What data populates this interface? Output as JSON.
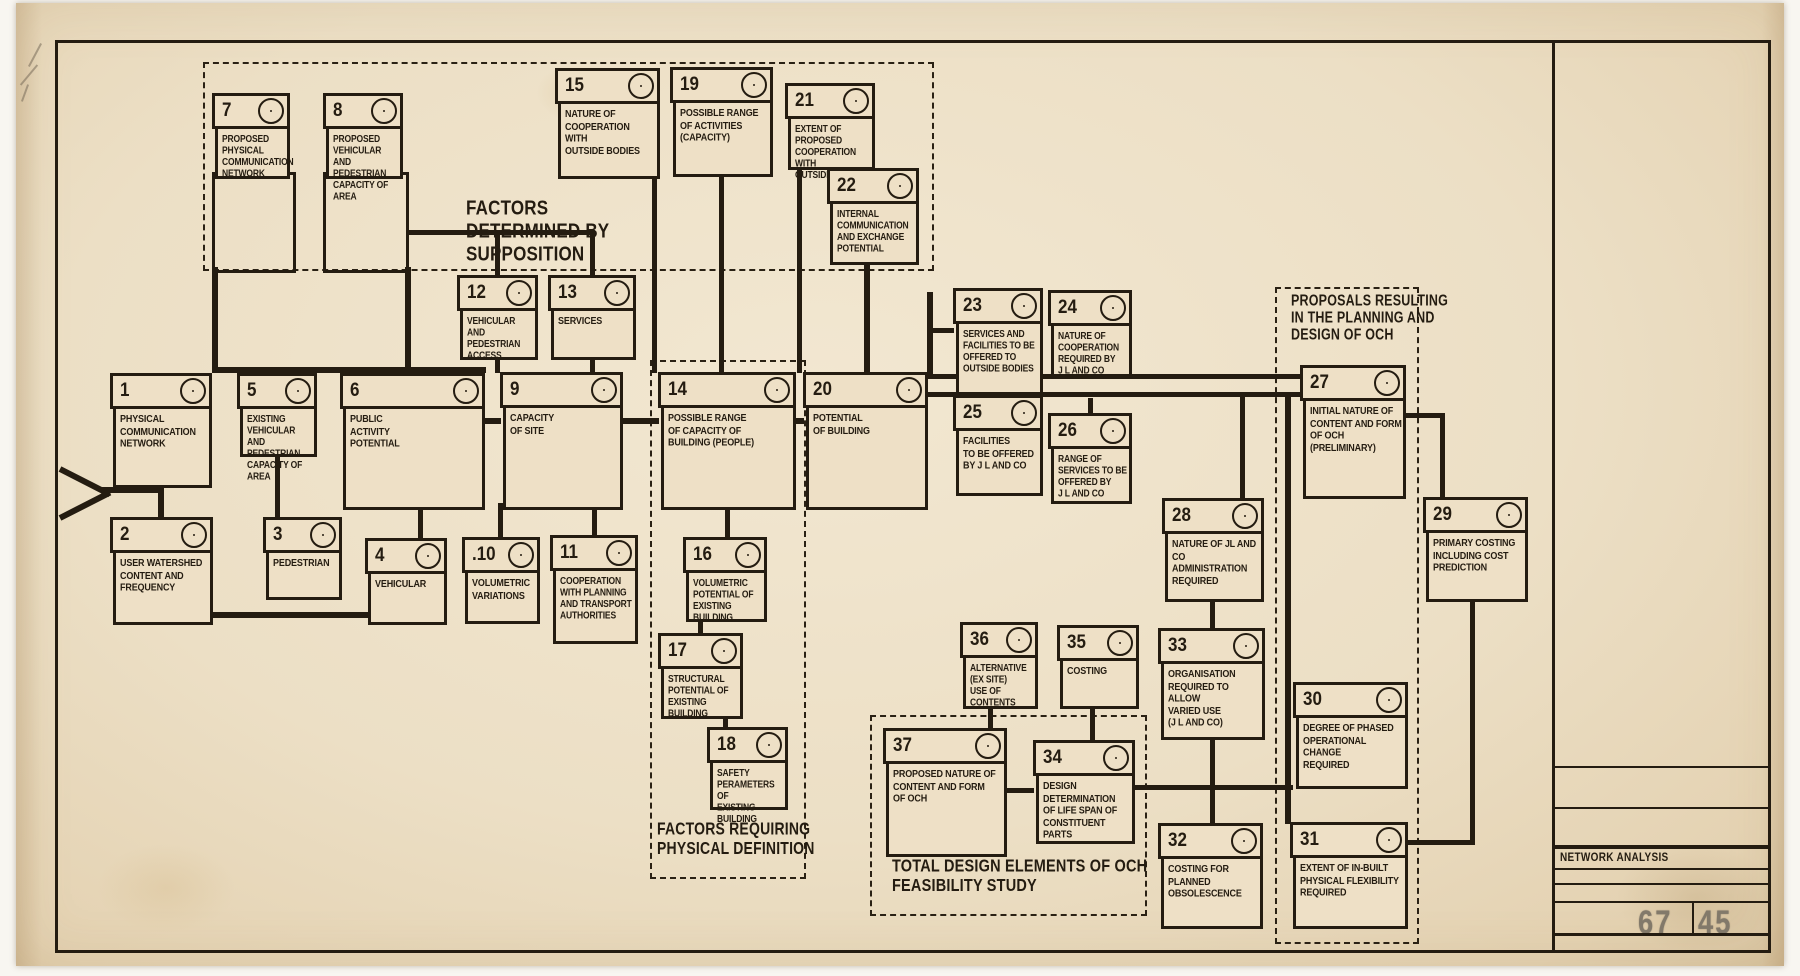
{
  "title_block": {
    "label": "NETWORK ANALYSIS",
    "sheet_number": "6745",
    "sheet_number_left": "67",
    "sheet_number_right": "45"
  },
  "colors": {
    "paper": "#ecdfc5",
    "ink": "#241c11",
    "stamp_grey": "#82796a"
  },
  "diagram": {
    "groups": [
      {
        "id": "supposition",
        "x": 203,
        "y": 62,
        "w": 727,
        "h": 205,
        "lx": 466,
        "ly": 196,
        "fs": 17,
        "label": "FACTORS\nDETERMINED BY\nSUPPOSITION"
      },
      {
        "id": "physical-definition",
        "x": 650,
        "y": 360,
        "w": 152,
        "h": 515,
        "lx": 657,
        "ly": 820,
        "fs": 14,
        "label": "FACTORS REQUIRING\nPHYSICAL DEFINITION"
      },
      {
        "id": "total-design",
        "x": 870,
        "y": 715,
        "w": 273,
        "h": 197,
        "lx": 892,
        "ly": 857,
        "fs": 14.5,
        "label": "TOTAL DESIGN ELEMENTS OF OCH\nFEASIBILITY STUDY"
      },
      {
        "id": "proposals",
        "x": 1275,
        "y": 287,
        "w": 140,
        "h": 653,
        "lx": 1291,
        "ly": 292,
        "fs": 12.5,
        "label": "PROPOSALS RESULTING\nIN THE PLANNING AND\nDESIGN OF OCH"
      }
    ],
    "nodes": [
      {
        "n": "1",
        "x": 110,
        "y": 373,
        "w": 102,
        "h": 76,
        "label": "PHYSICAL\nCOMMUNICATION\nNETWORK"
      },
      {
        "n": "2",
        "x": 110,
        "y": 517,
        "w": 103,
        "h": 69,
        "label": "USER WATERSHED\nCONTENT AND\nFREQUENCY"
      },
      {
        "n": "3",
        "x": 263,
        "y": 517,
        "w": 79,
        "h": 44,
        "label": "PEDESTRIAN"
      },
      {
        "n": "4",
        "x": 365,
        "y": 538,
        "w": 82,
        "h": 48,
        "label": "VEHICULAR"
      },
      {
        "n": "5",
        "x": 237,
        "y": 373,
        "w": 80,
        "h": 45,
        "fs": 8.5,
        "label": "EXISTING VEHICULAR\nAND PEDESTRIAN\nCAPACITY OF\nAREA"
      },
      {
        "n": "6",
        "x": 340,
        "y": 373,
        "w": 145,
        "h": 98,
        "label": "PUBLIC\nACTIVITY\nPOTENTIAL"
      },
      {
        "n": "7",
        "x": 212,
        "y": 93,
        "w": 78,
        "h": 47,
        "fs": 8.5,
        "label": "PROPOSED\nPHYSICAL\nCOMMUNICATION\nNETWORK"
      },
      {
        "n": "8",
        "x": 323,
        "y": 93,
        "w": 80,
        "h": 47,
        "fs": 8.5,
        "label": "PROPOSED\nVEHICULAR AND\nPEDESTRIAN\nCAPACITY OF AREA"
      },
      {
        "n": "9",
        "x": 500,
        "y": 372,
        "w": 123,
        "h": 99,
        "label": "CAPACITY\nOF SITE"
      },
      {
        "n": ".10",
        "x": 462,
        "y": 537,
        "w": 78,
        "h": 48,
        "label": "VOLUMETRIC\nVARIATIONS"
      },
      {
        "n": "11",
        "x": 550,
        "y": 535,
        "w": 88,
        "h": 70,
        "fs": 8.5,
        "label": "COOPERATION\nWITH PLANNING\nAND TRANSPORT\nAUTHORITIES"
      },
      {
        "n": "12",
        "x": 457,
        "y": 275,
        "w": 81,
        "h": 46,
        "fs": 8.5,
        "label": "VEHICULAR\nAND PEDESTRIAN\nACCESS"
      },
      {
        "n": "13",
        "x": 548,
        "y": 275,
        "w": 88,
        "h": 46,
        "label": "SERVICES"
      },
      {
        "n": "14",
        "x": 658,
        "y": 372,
        "w": 138,
        "h": 99,
        "label": "POSSIBLE RANGE\nOF CAPACITY OF\nBUILDING (PEOPLE)"
      },
      {
        "n": "15",
        "x": 555,
        "y": 68,
        "w": 105,
        "h": 72,
        "label": "NATURE OF\nCOOPERATION\nWITH\nOUTSIDE BODIES"
      },
      {
        "n": "16",
        "x": 683,
        "y": 537,
        "w": 84,
        "h": 46,
        "fs": 8.5,
        "label": "VOLUMETRIC\nPOTENTIAL OF\nEXISTING BUILDING"
      },
      {
        "n": "17",
        "x": 658,
        "y": 633,
        "w": 85,
        "h": 47,
        "fs": 8.5,
        "label": "STRUCTURAL\nPOTENTIAL OF\nEXISTING BUILDING"
      },
      {
        "n": "18",
        "x": 707,
        "y": 727,
        "w": 81,
        "h": 44,
        "fs": 8.5,
        "label": "SAFETY\nPERAMETERS OF\nEXISTING BUILDING"
      },
      {
        "n": "19",
        "x": 670,
        "y": 67,
        "w": 103,
        "h": 71,
        "label": "POSSIBLE RANGE\nOF ACTIVITIES\n(CAPACITY)"
      },
      {
        "n": "20",
        "x": 803,
        "y": 372,
        "w": 125,
        "h": 99,
        "label": "POTENTIAL\nOF BUILDING"
      },
      {
        "n": "21",
        "x": 785,
        "y": 83,
        "w": 90,
        "h": 48,
        "fs": 8.5,
        "label": "EXTENT OF\nPROPOSED\nCOOPERATION WITH\nOUTSIDE BODIES"
      },
      {
        "n": "22",
        "x": 827,
        "y": 168,
        "w": 92,
        "h": 58,
        "fs": 8.5,
        "label": "INTERNAL\nCOMMUNICATION\nAND EXCHANGE\nPOTENTIAL"
      },
      {
        "n": "23",
        "x": 953,
        "y": 288,
        "w": 90,
        "h": 68,
        "fs": 8.5,
        "label": "SERVICES AND\nFACILITIES TO BE\nOFFERED TO\nOUTSIDE BODIES"
      },
      {
        "n": "24",
        "x": 1048,
        "y": 290,
        "w": 84,
        "h": 48,
        "fs": 8.5,
        "label": "NATURE OF\nCOOPERATION\nREQUIRED BY\nJ L AND CO"
      },
      {
        "n": "25",
        "x": 953,
        "y": 395,
        "w": 90,
        "h": 62,
        "label": "FACILITIES\nTO BE OFFERED\nBY J L AND CO"
      },
      {
        "n": "26",
        "x": 1048,
        "y": 413,
        "w": 84,
        "h": 52,
        "fs": 8.5,
        "label": "RANGE OF\nSERVICES TO BE\nOFFERED BY\nJ L AND CO"
      },
      {
        "n": "27",
        "x": 1300,
        "y": 365,
        "w": 106,
        "h": 95,
        "label": "INITIAL NATURE OF\nCONTENT AND FORM\nOF OCH (PRELIMINARY)"
      },
      {
        "n": "28",
        "x": 1162,
        "y": 498,
        "w": 102,
        "h": 65,
        "label": "NATURE OF JL AND CO\nADMINISTRATION\nREQUIRED"
      },
      {
        "n": "29",
        "x": 1423,
        "y": 497,
        "w": 105,
        "h": 66,
        "label": "PRIMARY COSTING\nINCLUDING COST\nPREDICTION"
      },
      {
        "n": "30",
        "x": 1293,
        "y": 682,
        "w": 115,
        "h": 68,
        "label": "DEGREE OF PHASED\nOPERATIONAL CHANGE\nREQUIRED"
      },
      {
        "n": "31",
        "x": 1290,
        "y": 822,
        "w": 118,
        "h": 68,
        "label": "EXTENT OF IN-BUILT\nPHYSICAL FLEXIBILITY\nREQUIRED"
      },
      {
        "n": "32",
        "x": 1158,
        "y": 823,
        "w": 105,
        "h": 67,
        "label": "COSTING FOR\nPLANNED OBSOLESCENCE"
      },
      {
        "n": "33",
        "x": 1158,
        "y": 628,
        "w": 107,
        "h": 73,
        "label": "ORGANISATION\nREQUIRED TO ALLOW\nVARIED USE\n(J L AND CO)"
      },
      {
        "n": "34",
        "x": 1033,
        "y": 740,
        "w": 102,
        "h": 65,
        "label": "DESIGN DETERMINATION\nOF LIFE SPAN OF\nCONSTITUENT PARTS"
      },
      {
        "n": "35",
        "x": 1057,
        "y": 625,
        "w": 82,
        "h": 45,
        "label": "COSTING"
      },
      {
        "n": "36",
        "x": 960,
        "y": 622,
        "w": 78,
        "h": 48,
        "fs": 8.5,
        "label": "ALTERNATIVE\n(EX SITE)\nUSE OF CONTENTS"
      },
      {
        "n": "37",
        "x": 883,
        "y": 728,
        "w": 124,
        "h": 90,
        "label": "PROPOSED NATURE OF\nCONTENT AND FORM\nOF OCH"
      }
    ],
    "extension_boxes": [
      [
        212,
        172,
        78,
        95
      ],
      [
        323,
        172,
        80,
        95
      ]
    ],
    "connectors": [
      [
        102,
        487,
        60,
        6
      ],
      [
        158,
        481,
        6,
        38
      ],
      [
        275,
        450,
        5,
        67
      ],
      [
        212,
        267,
        6,
        101
      ],
      [
        405,
        267,
        6,
        101
      ],
      [
        212,
        367,
        274,
        6
      ],
      [
        407,
        230,
        188,
        5
      ],
      [
        495,
        233,
        5,
        42
      ],
      [
        590,
        233,
        5,
        42
      ],
      [
        495,
        354,
        5,
        19
      ],
      [
        590,
        354,
        5,
        19
      ],
      [
        652,
        172,
        5,
        201
      ],
      [
        719,
        170,
        5,
        203
      ],
      [
        797,
        163,
        5,
        210
      ],
      [
        864,
        258,
        6,
        115
      ],
      [
        927,
        292,
        6,
        83
      ],
      [
        930,
        328,
        24,
        5
      ],
      [
        928,
        374,
        374,
        5
      ],
      [
        928,
        392,
        374,
        5
      ],
      [
        1088,
        398,
        5,
        16
      ],
      [
        1285,
        394,
        6,
        430
      ],
      [
        1240,
        392,
        5,
        107
      ],
      [
        1210,
        595,
        5,
        34
      ],
      [
        1210,
        733,
        5,
        91
      ],
      [
        1090,
        702,
        5,
        39
      ],
      [
        988,
        702,
        5,
        27
      ],
      [
        1007,
        788,
        27,
        5
      ],
      [
        1135,
        785,
        158,
        5
      ],
      [
        1405,
        413,
        40,
        5
      ],
      [
        1440,
        413,
        5,
        85
      ],
      [
        1470,
        595,
        5,
        250
      ],
      [
        1408,
        840,
        67,
        5
      ],
      [
        418,
        503,
        5,
        36
      ],
      [
        498,
        503,
        5,
        35
      ],
      [
        592,
        503,
        5,
        33
      ],
      [
        213,
        612,
        234,
        6
      ],
      [
        725,
        503,
        5,
        35
      ],
      [
        698,
        615,
        5,
        19
      ],
      [
        723,
        712,
        5,
        16
      ],
      [
        485,
        418,
        16,
        6
      ],
      [
        622,
        418,
        37,
        6
      ],
      [
        795,
        418,
        9,
        6
      ]
    ],
    "frame_lines": [
      [
        55,
        40,
        1716,
        3
      ],
      [
        55,
        40,
        3,
        913
      ],
      [
        1768,
        40,
        3,
        913
      ],
      [
        55,
        950,
        1716,
        3
      ],
      [
        1552,
        40,
        3,
        910
      ],
      [
        1555,
        766,
        213,
        2
      ],
      [
        1555,
        807,
        213,
        2
      ],
      [
        1555,
        845,
        213,
        4
      ],
      [
        1555,
        868,
        213,
        2
      ],
      [
        1555,
        883,
        213,
        2
      ],
      [
        1555,
        901,
        213,
        2
      ],
      [
        1555,
        933,
        213,
        3
      ],
      [
        1692,
        901,
        2,
        34
      ]
    ]
  }
}
